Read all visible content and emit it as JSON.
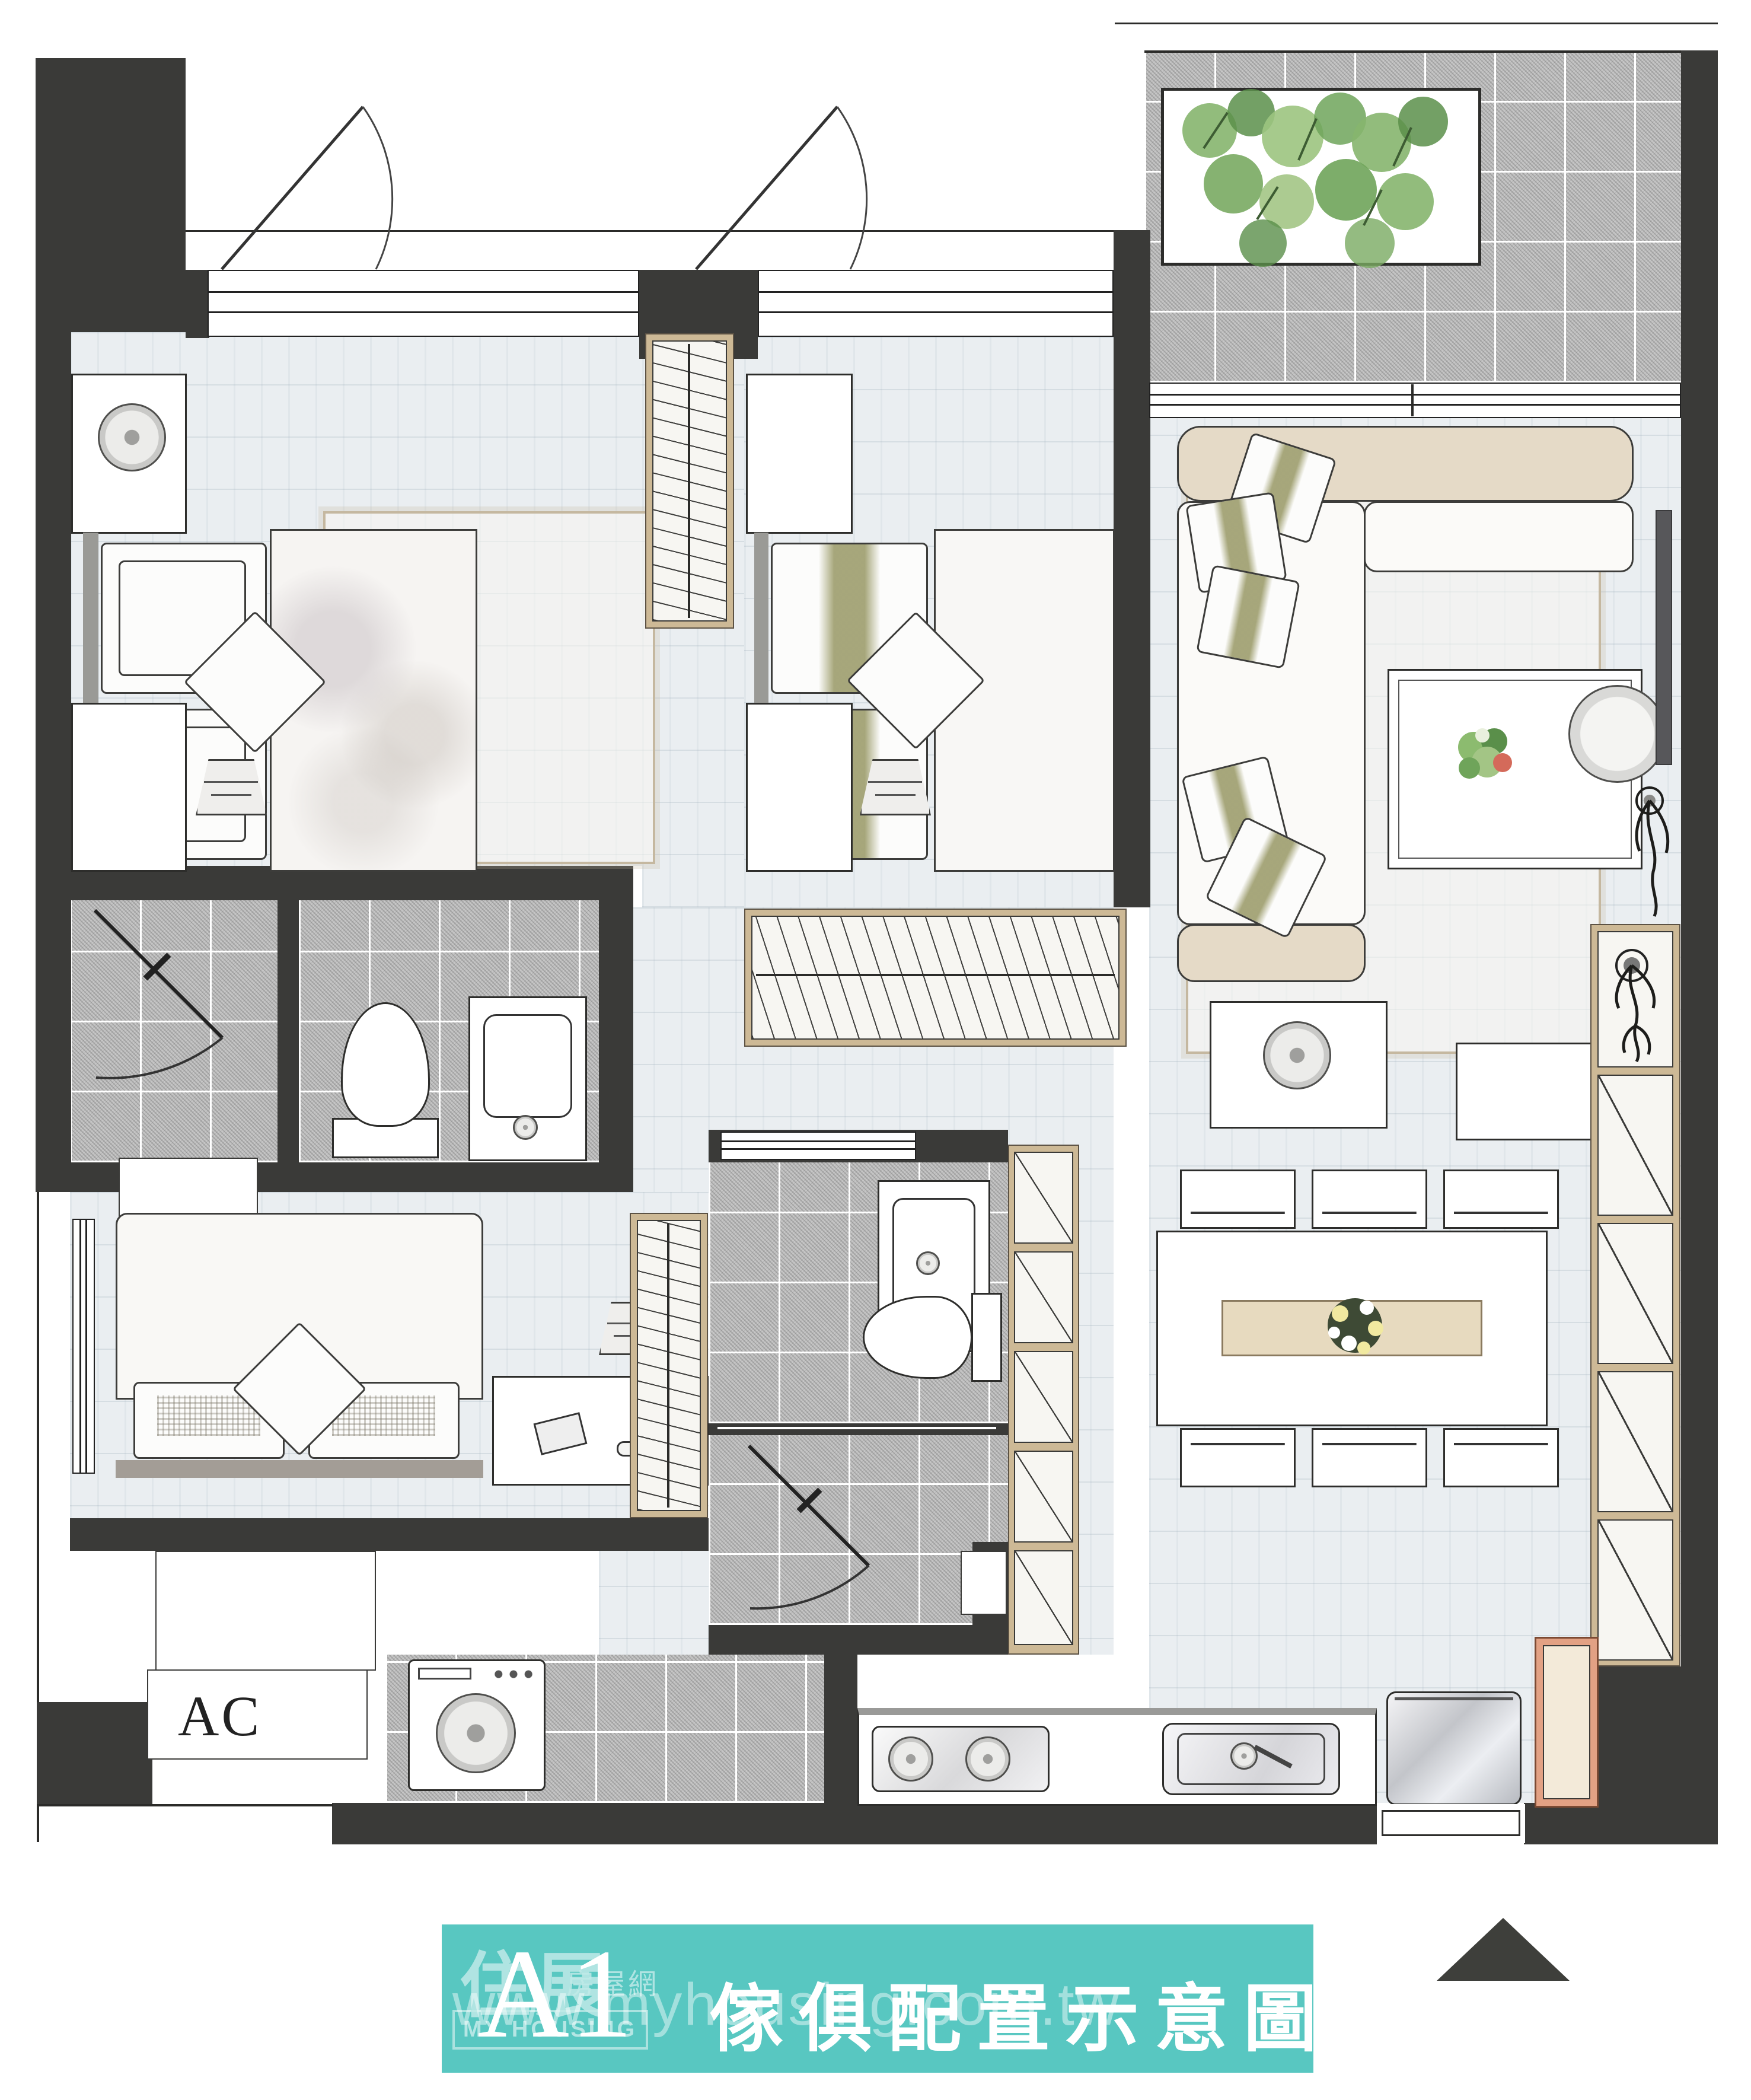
{
  "banner": {
    "unit_label": "A1",
    "title": "傢俱配置示意圖",
    "watermark": "www.myhousing.com.tw",
    "logo": {
      "cn_main": "住展",
      "cn_sub": "房屋網",
      "en": "MY HOUSING"
    },
    "background_color": "#58c7c1",
    "text_color": "#ffffff"
  },
  "plan": {
    "ac_label": "AC",
    "colors": {
      "wall": "#3a3a38",
      "wood_floor": "#eaeef1",
      "granite_tile": "#c6c6c6",
      "wood_accent": "#cdb996",
      "plant_green": "#7fb069",
      "tv_gray": "#57575a",
      "kitchen_cabinet_frame": "#e2a184"
    },
    "rooms": [
      "master-bedroom",
      "bedroom-2",
      "bedroom-3",
      "living-room",
      "dining-area",
      "kitchen",
      "laundry-area",
      "master-bathroom",
      "bathroom-2",
      "balcony",
      "entry",
      "ac-platform"
    ]
  },
  "compass": {
    "shape": "north-triangle",
    "color": "#3e3f3b"
  }
}
